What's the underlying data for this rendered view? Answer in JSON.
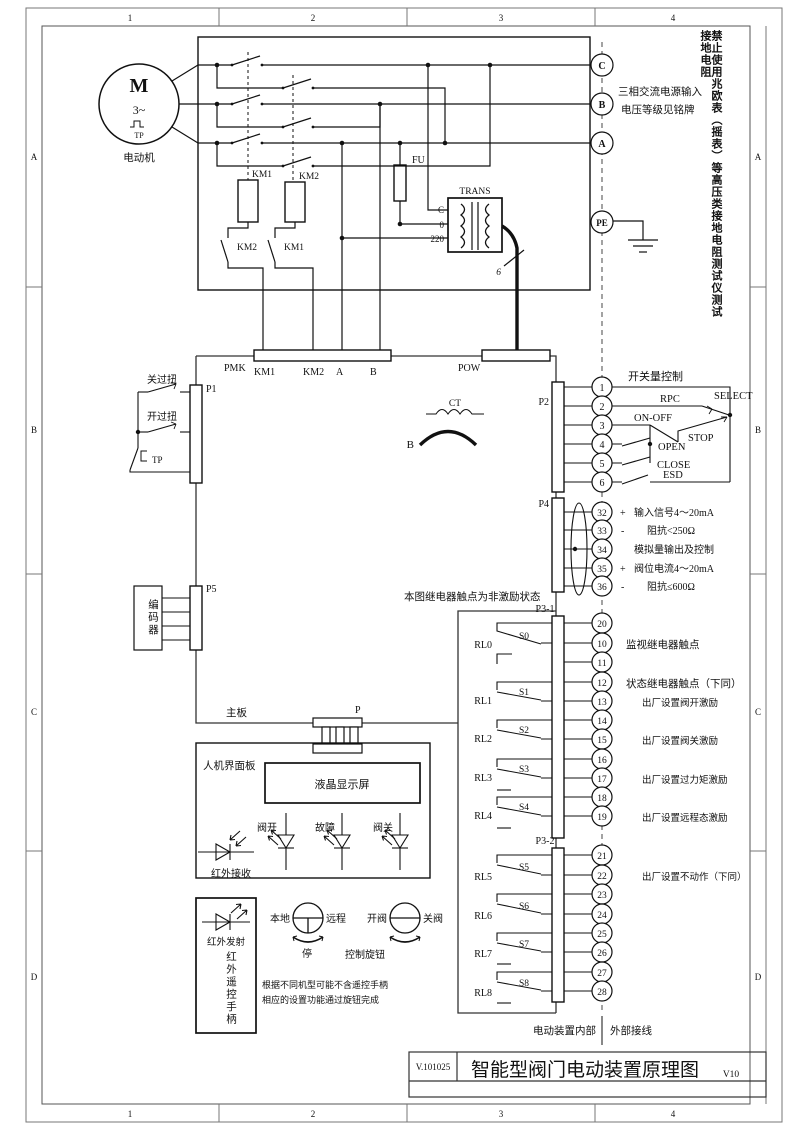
{
  "frame": {
    "cols": [
      "1",
      "2",
      "3",
      "4"
    ],
    "rows": [
      "A",
      "B",
      "C",
      "D"
    ]
  },
  "warning": "禁止使用兆欧表（摇表）等高压类接地电阻测试仪测试接地电阻",
  "supply": {
    "c": "C",
    "b": "B",
    "a": "A",
    "pe": "PE",
    "note1": "三相交流电源输入",
    "note2": "电压等级见铭牌"
  },
  "motor": {
    "m": "M",
    "phase": "3~",
    "tp": "TP",
    "label": "电动机"
  },
  "power": {
    "km1": "KM1",
    "km2": "KM2",
    "km1_aux": "KM2",
    "km2_aux": "KM1",
    "fu": "FU",
    "trans": "TRANS",
    "tap_c": "C",
    "tap_0": "0",
    "tap_220": "220",
    "wires": "6"
  },
  "strips": {
    "pmk": "PMK",
    "km1": "KM1",
    "km2": "KM2",
    "a": "A",
    "b": "B",
    "pow": "POW"
  },
  "board": {
    "label": "主板",
    "p": "P",
    "note": "本图继电器触点为非激励状态",
    "internal": "电动装置内部",
    "external": "外部接线"
  },
  "ct": {
    "label": "CT",
    "phase": "B"
  },
  "p1": {
    "label": "P1",
    "sw1": "关过扭",
    "sw2": "开过扭",
    "sw3": "TP"
  },
  "p5": {
    "label": "P5",
    "encoder": "编码器"
  },
  "p2": {
    "label": "P2",
    "title": "开关量控制",
    "t": [
      "1",
      "2",
      "3",
      "4",
      "5",
      "6"
    ],
    "rpc": "RPC",
    "select": "SELECT",
    "onoff": "ON-OFF",
    "stop": "STOP",
    "open": "OPEN",
    "close": "CLOSE",
    "esd": "ESD"
  },
  "p4": {
    "label": "P4",
    "rows": [
      {
        "no": "32",
        "pol": "+",
        "text": "输入信号4～20mA"
      },
      {
        "no": "33",
        "pol": "-",
        "text": "阻抗<250Ω"
      },
      {
        "no": "34",
        "pol": "",
        "text": "模拟量输出及控制"
      },
      {
        "no": "35",
        "pol": "+",
        "text": "阀位电流4～20mA"
      },
      {
        "no": "36",
        "pol": "-",
        "text": "阻抗≤600Ω"
      }
    ]
  },
  "p3_1": {
    "label": "P3-1",
    "t": [
      "20",
      "10",
      "11",
      "12",
      "13",
      "14",
      "15",
      "16",
      "17",
      "18",
      "19"
    ],
    "relays": [
      {
        "name": "RL0",
        "s": "S0"
      },
      {
        "name": "RL1",
        "s": "S1"
      },
      {
        "name": "RL2",
        "s": "S2"
      },
      {
        "name": "RL3",
        "s": "S3"
      },
      {
        "name": "RL4",
        "s": "S4"
      }
    ],
    "note_monitor": "监视继电器触点",
    "note_status": "状态继电器触点（下同）",
    "note_open": "出厂设置阀开激励",
    "note_close": "出厂设置阀关激励",
    "note_torque": "出厂设置过力矩激励",
    "note_remote": "出厂设置远程态激励"
  },
  "p3_2": {
    "label": "P3-2",
    "t": [
      "21",
      "22",
      "23",
      "24",
      "25",
      "26",
      "27",
      "28"
    ],
    "relays": [
      {
        "name": "RL5",
        "s": "S5"
      },
      {
        "name": "RL6",
        "s": "S6"
      },
      {
        "name": "RL7",
        "s": "S7"
      },
      {
        "name": "RL8",
        "s": "S8"
      }
    ],
    "note": "出厂设置不动作（下同）"
  },
  "hmi": {
    "label": "人机界面板",
    "lcd": "液晶显示屏",
    "led1": "阀开",
    "led2": "故障",
    "led3": "阀关",
    "ir_rx": "红外接收"
  },
  "remote": {
    "ir_tx": "红外发射",
    "handle": "红外遥控手柄",
    "note1": "根据不同机型可能不含遥控手柄",
    "note2": "相应的设置功能通过旋钮完成"
  },
  "knobs": {
    "k1l": "本地",
    "k1r": "远程",
    "k1b": "停",
    "k2l": "开阀",
    "k2r": "关阀",
    "label": "控制旋钮"
  },
  "titleblock": {
    "doc": "V.101025",
    "title": "智能型阀门电动装置原理图",
    "ver": "V10"
  }
}
